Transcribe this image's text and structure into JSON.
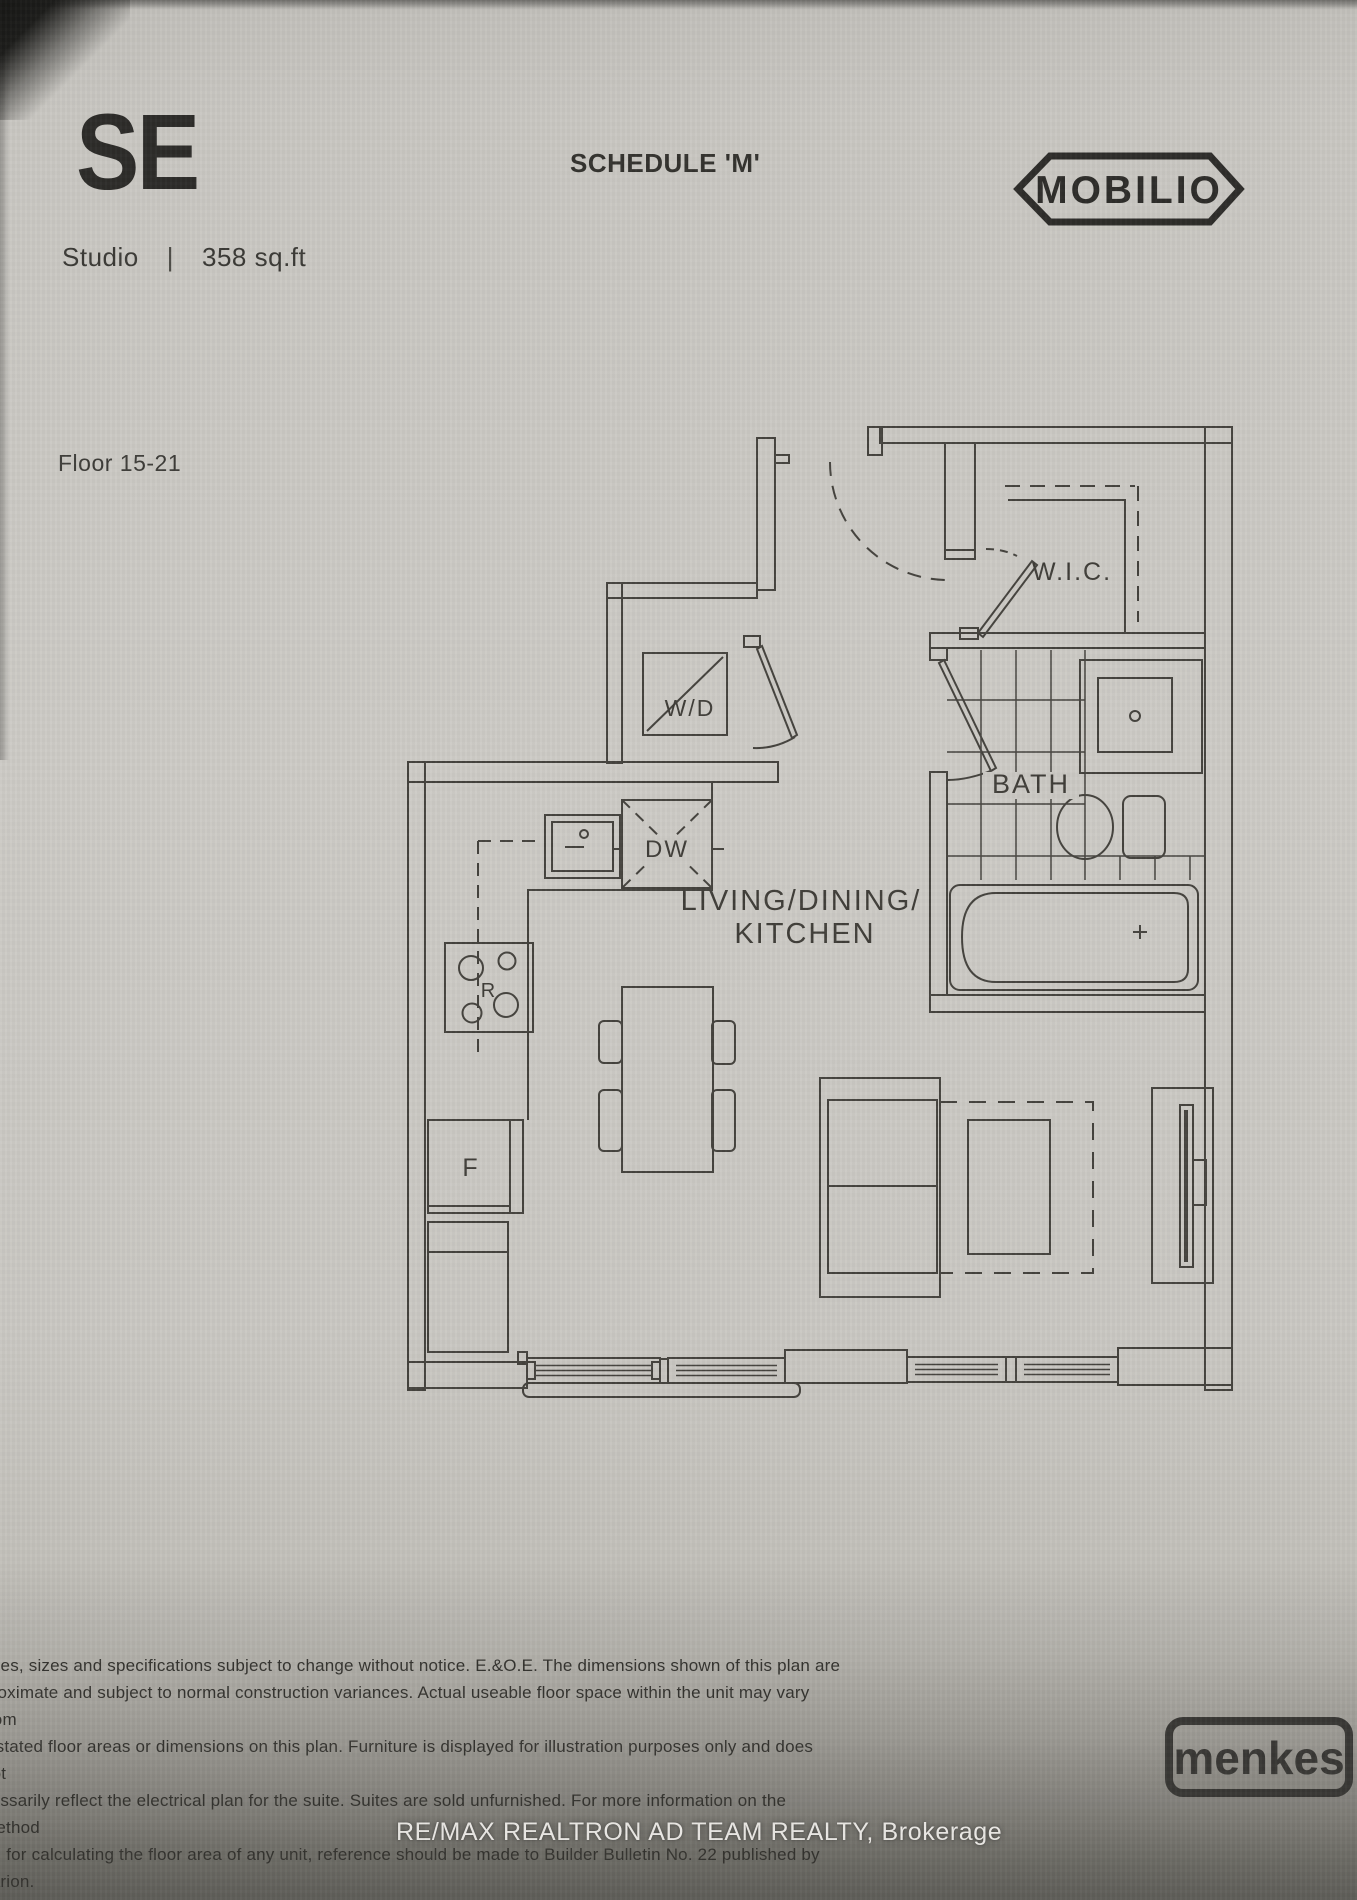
{
  "page": {
    "unit_code": "SE",
    "unit_type": "Studio",
    "separator": "|",
    "unit_area": "358 sq.ft",
    "schedule_title": "SCHEDULE 'M'",
    "project_name": "MOBILIO",
    "floor_range": "Floor 15-21"
  },
  "plan": {
    "room_labels": {
      "walk_in_closet": "W.I.C.",
      "bathroom": "BATH",
      "main_room_line1": "LIVING/DINING/",
      "main_room_line2": "KITCHEN"
    },
    "fixture_labels": {
      "washer_dryer": "W/D",
      "dishwasher": "DW",
      "range": "R",
      "fridge": "F"
    }
  },
  "footer": {
    "disclaimer_lines": [
      "rices, sizes and specifications subject to change without notice. E.&O.E. The dimensions shown of this plan are",
      "proximate and subject to normal construction variances. Actual useable floor space within the unit may vary from",
      "y stated floor areas or dimensions on this plan. Furniture is displayed for illustration purposes only and does not",
      "cessarily reflect the electrical plan for the suite. Suites are sold unfurnished. For more information on the method",
      "ed for calculating the floor area of any unit, reference should be made to Builder Bulletin No. 22 published by Tarion."
    ],
    "builder_logo": "menkes",
    "brokerage_watermark": "RE/MAX REALTRON AD TEAM REALTY, Brokerage"
  },
  "colors": {
    "paper": "#cbc9c4",
    "plan_ink": "#45433e",
    "heading_ink": "#2d2c29",
    "watermark_text": "#ebe9e5"
  }
}
